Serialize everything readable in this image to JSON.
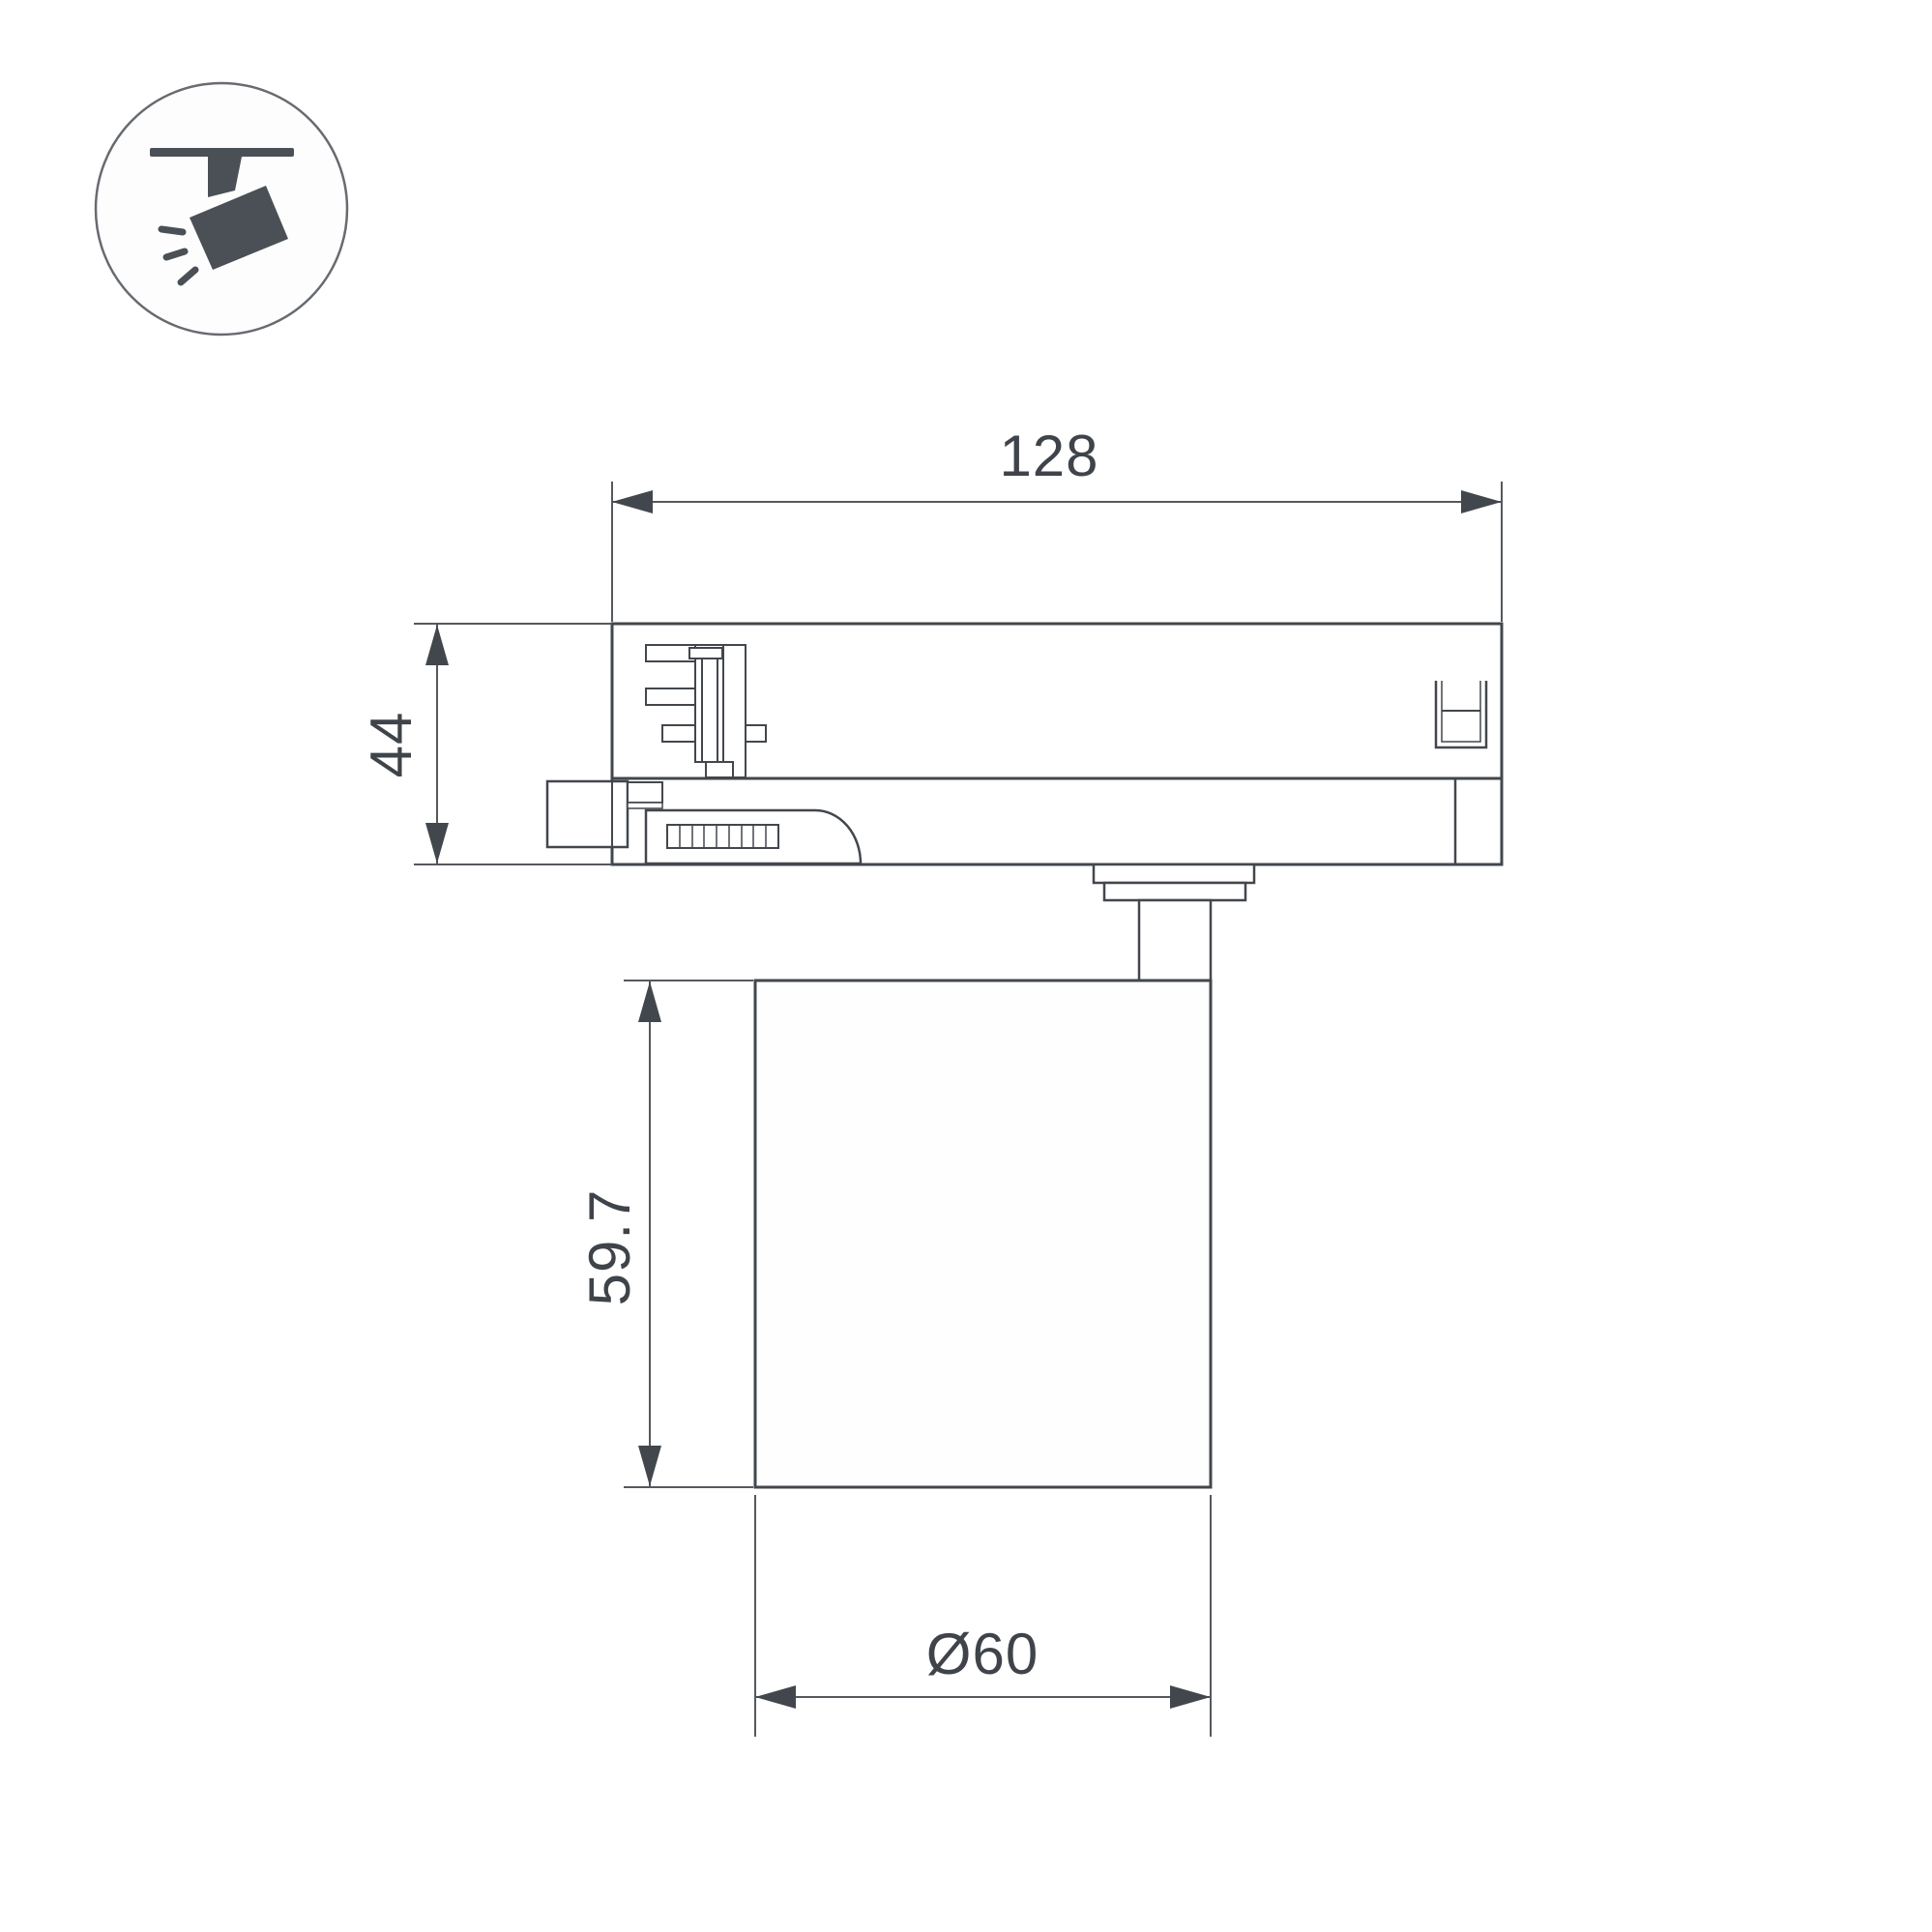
{
  "title": "track-light-dimension-drawing",
  "icon": {
    "name": "track-spotlight-icon"
  },
  "dimensions": {
    "track_width": "128",
    "adapter_height": "44",
    "body_height": "59.7",
    "body_diameter": "Ø60"
  },
  "colors": {
    "outline": "#42474d",
    "dimension": "#55595e",
    "text": "#3f444a",
    "icon": "#4a5055",
    "icon_circle": "#676b70",
    "background": "#ffffff"
  }
}
